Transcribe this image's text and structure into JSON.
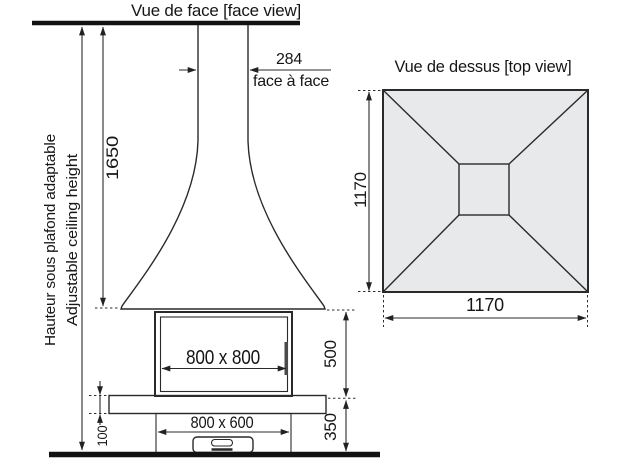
{
  "face_view": {
    "title": "Vue de face [face view]",
    "flue_width": {
      "value": "284",
      "label": "face à face"
    },
    "height": "1650",
    "ceiling_label_fr": "Hauteur sous plafond adaptable",
    "ceiling_label_en": "Adjustable ceiling height",
    "firebox_dim": "800 x 800",
    "base_dim": "800 x 600",
    "hearth_thickness": "100",
    "firebox_height": "500",
    "base_height": "350"
  },
  "top_view": {
    "title": "Vue de dessus [top view]",
    "width": "1170",
    "depth": "1170"
  },
  "colors": {
    "panel_fill": "#e8e9ea",
    "glass_top": "#d7e2eb",
    "glass_bottom": "#fcfdfe",
    "handle": "#4a4a4a",
    "line": "#2a2a2a",
    "heavy_line": "#121212",
    "text": "#161616"
  }
}
